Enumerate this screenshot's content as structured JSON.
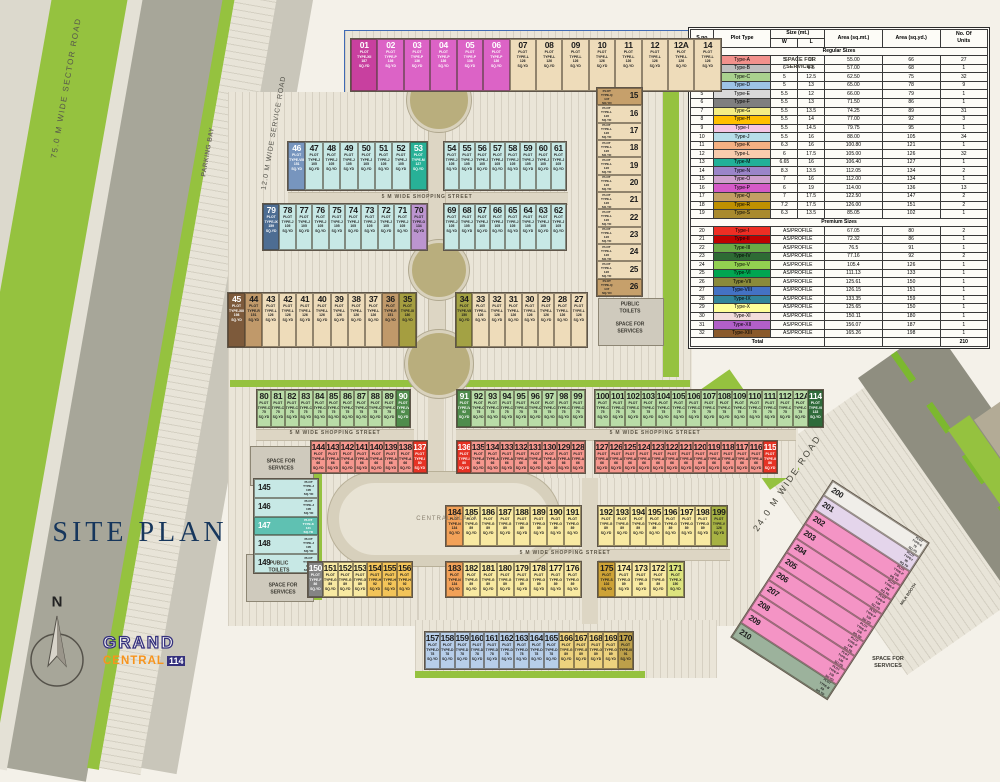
{
  "title": "SITE PLAN",
  "compass_label": "N",
  "logo": {
    "grand": "GRAND",
    "central": "CENTRAL",
    "num": "114"
  },
  "plot_types": {
    "A": {
      "label": "TYPE-A",
      "area": "66",
      "fill": "#f5978e",
      "swatch": "#f2918c"
    },
    "B": {
      "label": "TYPE-B",
      "area": "68",
      "fill": "#9cb29c",
      "swatch": "#bfbfbf"
    },
    "C": {
      "label": "TYPE-C",
      "area": "75",
      "fill": "#b9dca7",
      "swatch": "#a9d18e"
    },
    "D": {
      "label": "TYPE-D",
      "area": "78",
      "fill": "#b7cee9",
      "swatch": "#9dc3e6"
    },
    "E": {
      "label": "TYPE-E",
      "area": "79",
      "fill": "#f0eee9",
      "swatch": "#d9d9d9"
    },
    "F": {
      "label": "TYPE-F",
      "area": "86",
      "fill": "#848484",
      "swatch": "#7f7f7f",
      "dark": true
    },
    "G": {
      "label": "TYPE-G",
      "area": "89",
      "fill": "#f8e9a2",
      "swatch": "#f5ee84"
    },
    "G2": {
      "label": "TYPE-G",
      "area": "89",
      "fill": "#edd27e",
      "swatch": "#f5ee84"
    },
    "H": {
      "label": "TYPE-H",
      "area": "92",
      "fill": "#f3c459",
      "swatch": "#ffc000"
    },
    "I": {
      "label": "TYPE-I",
      "area": "95",
      "fill": "#e4d5eb",
      "swatch": "#f6c6e4"
    },
    "J": {
      "label": "TYPE-J",
      "area": "105",
      "fill": "#c7e8e5",
      "swatch": "#b7dee8"
    },
    "K": {
      "label": "TYPE-K",
      "area": "121",
      "fill": "#5fc1b2",
      "swatch": "#f4b183",
      "dark": true
    },
    "L": {
      "label": "TYPE-L",
      "area": "126",
      "fill": "#eedcba",
      "swatch": "#f8cbad"
    },
    "M": {
      "label": "TYPE-M",
      "area": "127",
      "fill": "#28b197",
      "swatch": "#21b098",
      "dark": true
    },
    "N": {
      "label": "TYPE-N",
      "area": "134",
      "fill": "#f2a158",
      "swatch": "#9b85c9"
    },
    "O": {
      "label": "TYPE-O",
      "area": "134",
      "fill": "#bc95d0",
      "swatch": "#cfa0ce"
    },
    "P": {
      "label": "TYPE-P",
      "area": "136",
      "fill": "#dc63c6",
      "swatch": "#d55ac8",
      "dark": true
    },
    "P2": {
      "label": "TYPE-P",
      "area": "136",
      "fill": "#f494c5",
      "swatch": "#d55ac8"
    },
    "Q": {
      "label": "TYPE-Q",
      "area": "147",
      "fill": "#c6a06b",
      "swatch": "#c3a064"
    },
    "R": {
      "label": "TYPE-R",
      "area": "151",
      "fill": "#c0996a",
      "swatch": "#bf9000"
    },
    "S": {
      "label": "TYPE-S",
      "area": "102",
      "fill": "#cda236",
      "swatch": "#a98a2e"
    },
    "pI": {
      "label": "TYPE-I",
      "area": "80",
      "fill": "#e63224",
      "swatch": "#ee2e24",
      "dark": true
    },
    "pII": {
      "label": "TYPE-II",
      "area": "86",
      "fill": "#e63224",
      "swatch": "#c00000",
      "dark": true
    },
    "pIII": {
      "label": "TYPE-III",
      "area": "91",
      "fill": "#bda04a",
      "swatch": "#6aaa46"
    },
    "pIV": {
      "label": "TYPE-IV",
      "area": "92",
      "fill": "#4f8c4c",
      "swatch": "#2e6b34",
      "dark": true
    },
    "pV": {
      "label": "TYPE-V",
      "area": "126",
      "fill": "#a7b243",
      "swatch": "#92d050"
    },
    "pVI": {
      "label": "TYPE-VI",
      "area": "133",
      "fill": "#2f6b3b",
      "swatch": "#00a651",
      "dark": true
    },
    "pVII": {
      "label": "TYPE-VII",
      "area": "150",
      "fill": "#a3a244",
      "swatch": "#8a8a3a"
    },
    "pVIII": {
      "label": "TYPE-VIII",
      "area": "151",
      "fill": "#7795be",
      "swatch": "#4472c4",
      "dark": true
    },
    "pIX": {
      "label": "TYPE-IX",
      "area": "159",
      "fill": "#4d6d93",
      "swatch": "#31849b",
      "dark": true
    },
    "pX": {
      "label": "TYPE-X",
      "area": "150",
      "fill": "#dde47e",
      "swatch": "#ffff99"
    },
    "pXI": {
      "label": "TYPE-XI",
      "area": "180",
      "fill": "#a59e40",
      "swatch": "#f2dcdb"
    },
    "pXII": {
      "label": "TYPE-XII",
      "area": "187",
      "fill": "#c8409f",
      "swatch": "#b15fc9",
      "dark": true
    },
    "pXIII": {
      "label": "TYPE-XIII",
      "area": "198",
      "fill": "#7d5a3b",
      "swatch": "#8a5a2b",
      "dark": true
    }
  },
  "site": {
    "strips": [
      {
        "x": 350,
        "y": 38,
        "w": 372,
        "h": 54,
        "cells": "01:pXII,02:P,03:P,04:P,05:P,06:P,07:L,08:L,09:L,10:L,11:L,12:L,12A:L,14:L"
      },
      {
        "x": 596,
        "y": 87,
        "w": 47,
        "h": 210,
        "mode": "v",
        "cells": "15:Q,16:L,17:L,18:L,19:L,20:L,21:L,22:L,23:L,24:L,25:L,26:Q"
      },
      {
        "x": 287,
        "y": 141,
        "w": 141,
        "h": 50,
        "cells": "46:pVIII,47:J,48:J,49:J,50:J,51:J,52:J,53:M"
      },
      {
        "x": 443,
        "y": 141,
        "w": 124,
        "h": 50,
        "cells": "54:J,55:J,56:J,57:J,58:J,59:J,60:J,61:J"
      },
      {
        "x": 262,
        "y": 203,
        "w": 166,
        "h": 48,
        "cells": "79:pIX,78:J,77:J,76:J,75:J,74:J,73:J,72:J,71:J,70:O"
      },
      {
        "x": 443,
        "y": 203,
        "w": 124,
        "h": 48,
        "cells": "69:J,68:J,67:J,66:J,65:J,64:J,63:J,62:J"
      },
      {
        "x": 227,
        "y": 292,
        "w": 190,
        "h": 56,
        "cells": "45:pXIII,44:R,43:L,42:L,41:L,40:L,39:L,38:L,37:L,36:R,35:pXI"
      },
      {
        "x": 455,
        "y": 292,
        "w": 133,
        "h": 56,
        "cells": "34:pVII,33:L,32:L,31:L,30:L,29:L,28:L,27:L"
      },
      {
        "x": 256,
        "y": 389,
        "w": 155,
        "h": 39,
        "cells": "80:C,81:C,82:C,83:C,84:C,85:C,86:C,87:C,88:C,89:C,90:pIV"
      },
      {
        "x": 456,
        "y": 389,
        "w": 130,
        "h": 39,
        "cells": "91:pIV,92:C,93:C,94:C,95:C,96:C,97:C,98:C,99:C"
      },
      {
        "x": 594,
        "y": 389,
        "w": 230,
        "h": 39,
        "cells": "100:C,101:C,102:C,103:C,104:C,105:C,106:C,107:C,108:C,109:C,110:C,111:C,112:C,112A:C,114:pVI"
      },
      {
        "x": 310,
        "y": 440,
        "w": 118,
        "h": 34,
        "cells": "144:A,143:A,142:A,141:A,140:A,139:A,138:A,137:pI"
      },
      {
        "x": 456,
        "y": 440,
        "w": 130,
        "h": 34,
        "cells": "136:pI,135:A,134:A,133:A,132:A,131:A,130:A,129:A,128:A"
      },
      {
        "x": 594,
        "y": 440,
        "w": 184,
        "h": 34,
        "cells": "127:A,126:A,125:A,124:A,123:A,122:A,121:A,120:A,119:A,118:A,117:A,116:A,115:pII"
      },
      {
        "x": 253,
        "y": 478,
        "w": 66,
        "h": 96,
        "mode": "v",
        "numFirst": true,
        "cells": "145:J,146:J,147:K,148:J,149:J"
      },
      {
        "x": 307,
        "y": 561,
        "w": 106,
        "h": 37,
        "cells": "150:F,151:G,152:G,153:G,154:H,155:H,156:H"
      },
      {
        "x": 445,
        "y": 505,
        "w": 137,
        "h": 42,
        "cells": "184:N,185:G,186:G,187:G,188:G,189:G,190:G,191:G"
      },
      {
        "x": 597,
        "y": 505,
        "w": 131,
        "h": 42,
        "cells": "192:G,193:G,194:G,195:G,196:G,197:G,198:G,199:pV"
      },
      {
        "x": 445,
        "y": 561,
        "w": 137,
        "h": 37,
        "cells": "183:N,182:G,181:G,180:G,179:G,178:G,177:G,176:G"
      },
      {
        "x": 597,
        "y": 561,
        "w": 88,
        "h": 37,
        "cells": "175:S,174:G,173:G,172:G,171:pX"
      },
      {
        "x": 424,
        "y": 631,
        "w": 210,
        "h": 39,
        "cells": "157:D,158:D,159:D,160:D,161:D,162:D,163:D,164:D,165:D,166:G2,167:G2,168:G2,169:G2,170:pIII"
      },
      {
        "x": 772,
        "y": 496,
        "w": 116,
        "h": 188,
        "mode": "v",
        "numFirst": true,
        "rot": 33,
        "cells": "200:E,201:I,202:P2,203:P2,204:P2,205:P2,206:P2,207:P2,208:P2,209:P2,210:B"
      }
    ],
    "labels": [
      {
        "t": "75.0 M WIDE SECTOR ROAD",
        "x": 66,
        "y": 88,
        "s": 8,
        "r": -80,
        "c": "#55544c",
        "ls": 1.5
      },
      {
        "t": "PARKING BAY",
        "x": 208,
        "y": 152,
        "s": 6.5,
        "r": -80,
        "c": "#6a675c",
        "ls": 0.5,
        "b": 1
      },
      {
        "t": "12.0 M WIDE SERVICE ROAD",
        "x": 274,
        "y": 133,
        "s": 7,
        "r": -80,
        "c": "#55544c",
        "ls": 0.8
      },
      {
        "t": "24.0 M WIDE ROAD",
        "x": 787,
        "y": 483,
        "s": 9,
        "r": -56,
        "c": "#45443a",
        "ls": 2
      },
      {
        "t": "5 M WIDE SHOPPING STREET",
        "x": 427,
        "y": 197,
        "s": 5,
        "c": "#5c5546",
        "ls": 0.8,
        "b": 1
      },
      {
        "t": "5 M WIDE SHOPPING STREET",
        "x": 335,
        "y": 433,
        "s": 5,
        "c": "#5c5546",
        "ls": 0.8,
        "b": 1
      },
      {
        "t": "5 M WIDE SHOPPING STREET",
        "x": 655,
        "y": 433,
        "s": 5,
        "c": "#5c5546",
        "ls": 0.8,
        "b": 1
      },
      {
        "t": "5 M WIDE SHOPPING STREET",
        "x": 565,
        "y": 553,
        "s": 5,
        "c": "#5c5546",
        "ls": 0.8,
        "b": 1
      },
      {
        "t": "SPACE FOR SERVICES",
        "x": 800,
        "y": 64,
        "s": 5.5,
        "b": 1,
        "c": "#3c3a32",
        "wrap": 40
      },
      {
        "t": "PUBLIC TOILETS",
        "x": 630,
        "y": 308,
        "s": 5,
        "b": 1,
        "c": "#3c3a32",
        "wrap": 30
      },
      {
        "t": "SPACE FOR SERVICES",
        "x": 630,
        "y": 328,
        "s": 5,
        "b": 1,
        "c": "#3c3a32",
        "wrap": 36
      },
      {
        "t": "SPACE FOR SERVICES",
        "x": 281,
        "y": 465,
        "s": 5,
        "b": 1,
        "c": "#3c3a32",
        "wrap": 36
      },
      {
        "t": "PUBLIC TOILETS",
        "x": 279,
        "y": 567,
        "s": 5,
        "b": 1,
        "c": "#3c3a32",
        "wrap": 30
      },
      {
        "t": "SPACE FOR SERVICES",
        "x": 283,
        "y": 589,
        "s": 5,
        "b": 1,
        "c": "#3c3a32",
        "wrap": 36
      },
      {
        "t": "SPACE FOR SERVICES",
        "x": 888,
        "y": 663,
        "s": 5.5,
        "b": 1,
        "c": "#3c3a32",
        "wrap": 40
      },
      {
        "t": "CENTRAL PLAZA",
        "x": 447,
        "y": 519,
        "s": 6,
        "c": "#8a8171",
        "ls": 1
      },
      {
        "t": "MILK BOOTH",
        "x": 908,
        "y": 594,
        "s": 4,
        "r": -56,
        "c": "#3c3a32",
        "b": 1
      },
      {
        "t": "SITE PLAN",
        "x": 140,
        "y": 533,
        "s": 28,
        "c": "#16365c",
        "ls": 4,
        "serif": 1
      },
      {
        "t": "N",
        "x": 57,
        "y": 602,
        "s": 15,
        "c": "#222",
        "b": 1
      }
    ]
  },
  "table": {
    "headers": {
      "sno": "S.no",
      "plot_type": "Plot Type",
      "size": "Size (mt.)",
      "w": "W",
      "l": "L",
      "area_m": "Area (sq.mt.)",
      "area_y": "Area (sq.yd.)",
      "units1": "No. Of",
      "units2": "Units"
    },
    "regular_title": "Regular Sizes",
    "premium_title": "Premium Sizes",
    "as_profile": "AS/PROFILE",
    "total_label": "Total",
    "total_units": "210",
    "type_prefix": "Type-",
    "regular_rows": [
      [
        "1",
        "A",
        "5",
        "11",
        "55.00",
        "66",
        "27"
      ],
      [
        "2",
        "B",
        "6",
        "9.5",
        "57.00",
        "68",
        "1"
      ],
      [
        "3",
        "C",
        "5",
        "12.5",
        "62.50",
        "75",
        "32"
      ],
      [
        "4",
        "D",
        "5",
        "13",
        "65.00",
        "78",
        "9"
      ],
      [
        "5",
        "E",
        "5.5",
        "12",
        "66.00",
        "79",
        "1"
      ],
      [
        "6",
        "F",
        "5.5",
        "13",
        "71.50",
        "86",
        "1"
      ],
      [
        "7",
        "G",
        "5.5",
        "13.5",
        "74.25",
        "89",
        "31"
      ],
      [
        "8",
        "H",
        "5.5",
        "14",
        "77.00",
        "92",
        "3"
      ],
      [
        "9",
        "I",
        "5.5",
        "14.5",
        "79.75",
        "95",
        "1"
      ],
      [
        "10",
        "J",
        "5.5",
        "16",
        "88.00",
        "105",
        "34"
      ],
      [
        "11",
        "K",
        "6.3",
        "16",
        "100.80",
        "121",
        "1"
      ],
      [
        "12",
        "L",
        "6",
        "17.5",
        "105.00",
        "126",
        "32"
      ],
      [
        "13",
        "M",
        "6.65",
        "16",
        "106.40",
        "127",
        "1"
      ],
      [
        "14",
        "N",
        "8.3",
        "13.5",
        "112.05",
        "134",
        "2"
      ],
      [
        "15",
        "O",
        "7",
        "16",
        "112.00",
        "134",
        "1"
      ],
      [
        "16",
        "P",
        "6",
        "19",
        "114.00",
        "136",
        "13"
      ],
      [
        "17",
        "Q",
        "7",
        "17.5",
        "122.50",
        "147",
        "2"
      ],
      [
        "18",
        "R",
        "7.2",
        "17.5",
        "126.00",
        "151",
        "2"
      ],
      [
        "19",
        "S",
        "6.3",
        "13.5",
        "85.05",
        "102",
        "1"
      ]
    ],
    "premium_rows": [
      [
        "20",
        "pI",
        "67.05",
        "80",
        "2"
      ],
      [
        "21",
        "pII",
        "72.32",
        "86",
        "1"
      ],
      [
        "22",
        "pIII",
        "76.5",
        "91",
        "1"
      ],
      [
        "23",
        "pIV",
        "77.16",
        "92",
        "2"
      ],
      [
        "24",
        "pV",
        "105.4",
        "126",
        "1"
      ],
      [
        "25",
        "pVI",
        "111.13",
        "133",
        "1"
      ],
      [
        "26",
        "pVII",
        "125.61",
        "150",
        "1"
      ],
      [
        "27",
        "pVIII",
        "126.15",
        "151",
        "1"
      ],
      [
        "28",
        "pIX",
        "133.35",
        "159",
        "1"
      ],
      [
        "29",
        "pX",
        "125.65",
        "150",
        "1"
      ],
      [
        "30",
        "pXI",
        "150.11",
        "180",
        "1"
      ],
      [
        "31",
        "pXII",
        "156.07",
        "187",
        "1"
      ],
      [
        "32",
        "pXIII",
        "165.26",
        "198",
        "1"
      ]
    ]
  }
}
